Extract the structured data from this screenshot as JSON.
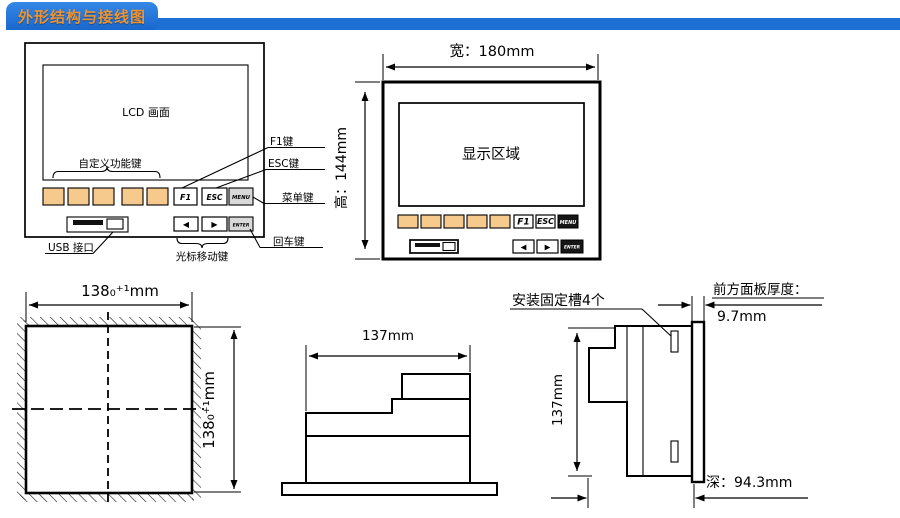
{
  "header": {
    "title": "外形结构与接线图"
  },
  "colors": {
    "banner_blue": "#1c70d4",
    "tab_blue": "#1a67cc",
    "title_orange": "#f0922d",
    "function_key_orange": "#f6c98c",
    "line_black": "#000000"
  },
  "front_panel_view": {
    "lcd_label": "LCD 画面",
    "custom_keys_label": "自定义功能键",
    "usb_label": "USB 接口",
    "cursor_keys_label": "光标移动键",
    "f1_callout": "F1键",
    "esc_callout": "ESC键",
    "menu_callout": "菜单键",
    "enter_callout": "回车键",
    "keys": {
      "f1": "F1",
      "esc": "ESC",
      "menu": "MENU",
      "enter": "ENTER",
      "left": "◀",
      "right": "▶"
    }
  },
  "dimensioned_view": {
    "width_dim": "宽：180mm",
    "height_dim": "高：144mm",
    "display_label": "显示区域",
    "keys": {
      "f1": "F1",
      "esc": "ESC",
      "menu": "MENU",
      "enter": "ENTER",
      "left": "◀",
      "right": "▶"
    }
  },
  "cutout_view": {
    "width_dim": "138₀⁺¹mm",
    "height_dim": "138₀⁺¹mm"
  },
  "top_view": {
    "width_dim": "137mm"
  },
  "side_view": {
    "slots_label": "安装固定槽4个",
    "thickness_label": "前方面板厚度：",
    "thickness_dim": "9.7mm",
    "height_dim": "137mm",
    "depth_dim": "深：94.3mm"
  }
}
